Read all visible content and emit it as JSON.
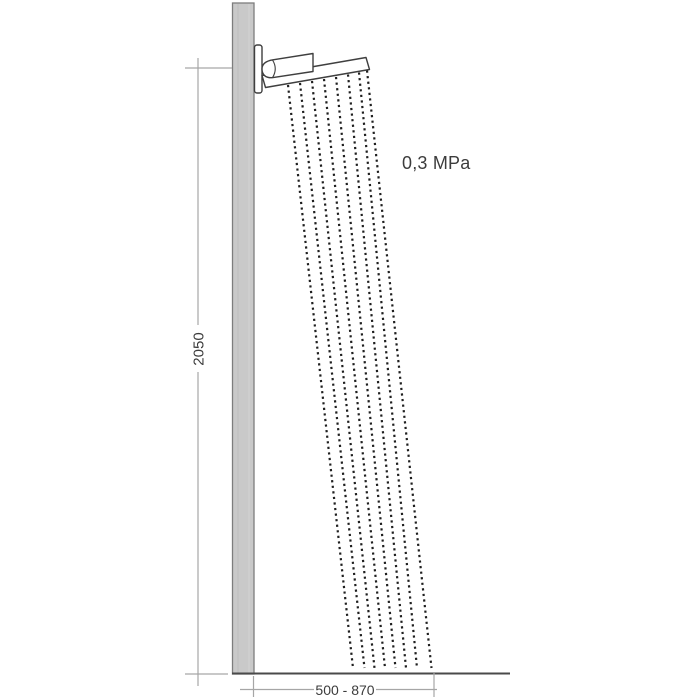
{
  "diagram": {
    "pressure_label": "0,3 MPa",
    "height_dimension_label": "2050",
    "reach_dimension_label": "500 - 870"
  },
  "colors": {
    "background": "#ffffff",
    "wall_fill": "#c9c9c9",
    "wall_edge": "#7d7d7d",
    "fixture_outline": "#3f3f3f",
    "dimension_line": "#a6a6a6",
    "floor_line": "#4a4a4a",
    "water_dot": "#1f1f1f",
    "text": "#3c3c3c"
  }
}
